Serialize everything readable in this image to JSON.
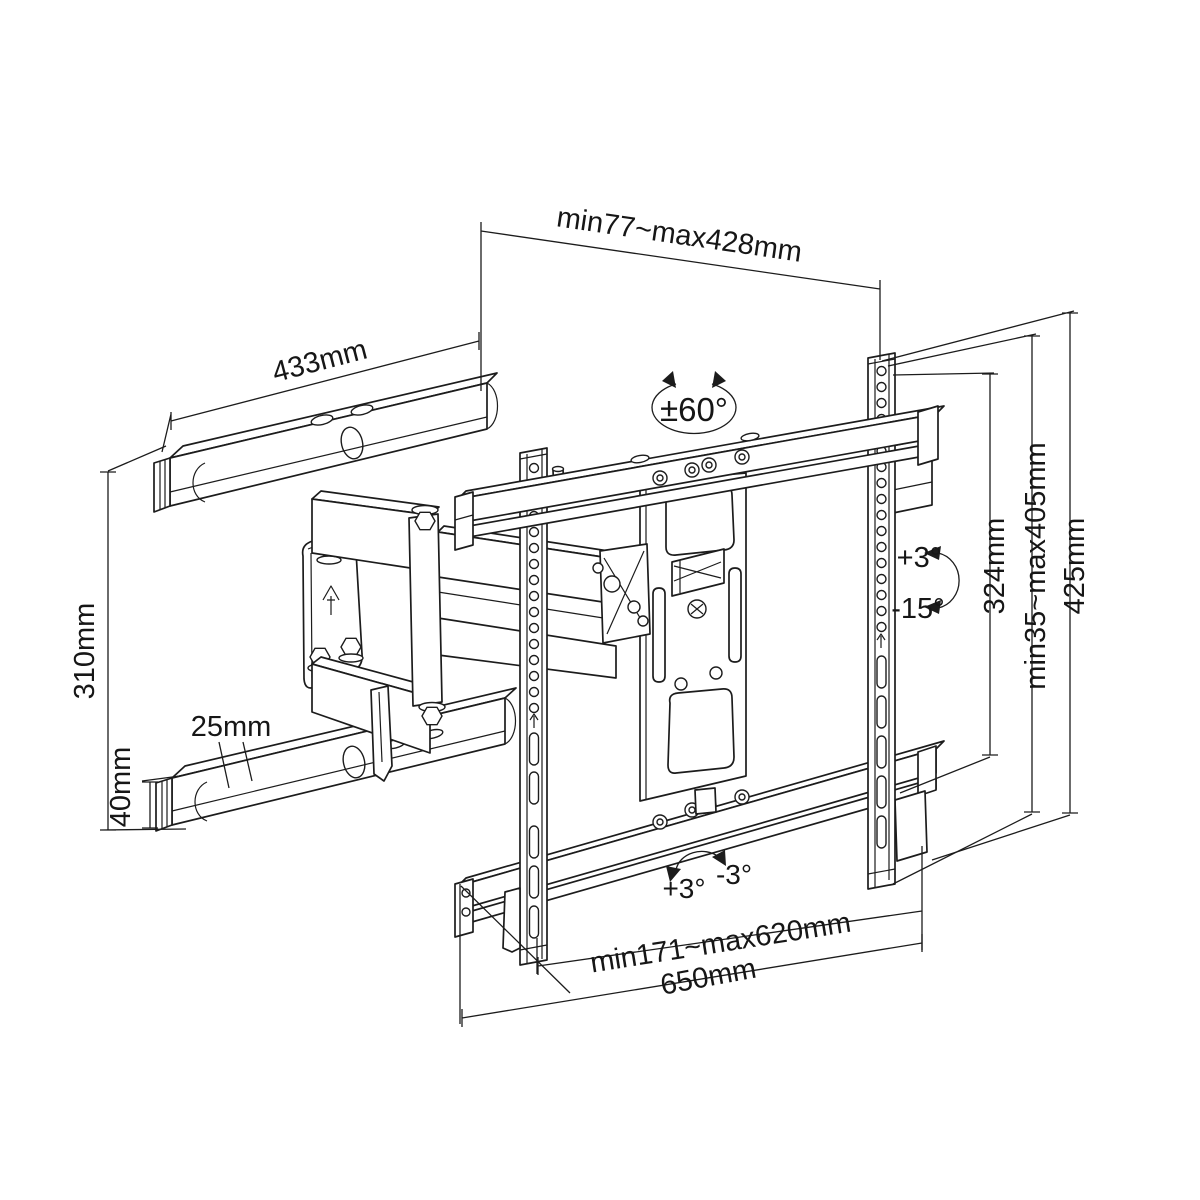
{
  "colors": {
    "ink": "#1c1c1c",
    "paper": "#ffffff"
  },
  "annotations": {
    "depth_range": "min77~max428mm",
    "wall_rail_length": "433mm",
    "swivel_range": "±60°",
    "wall_plate_height": "310mm",
    "arm_offset": "25mm",
    "wall_rail_height": "40mm",
    "tilt_up": "+3°",
    "tilt_down": "-15°",
    "rail_column_height": "324mm",
    "vertical_adjust_range": "min35~max405mm",
    "total_height": "425mm",
    "level_plus": "+3°",
    "level_minus": "-3°",
    "horizontal_adjust_range": "min171~max620mm",
    "total_width": "650mm"
  }
}
